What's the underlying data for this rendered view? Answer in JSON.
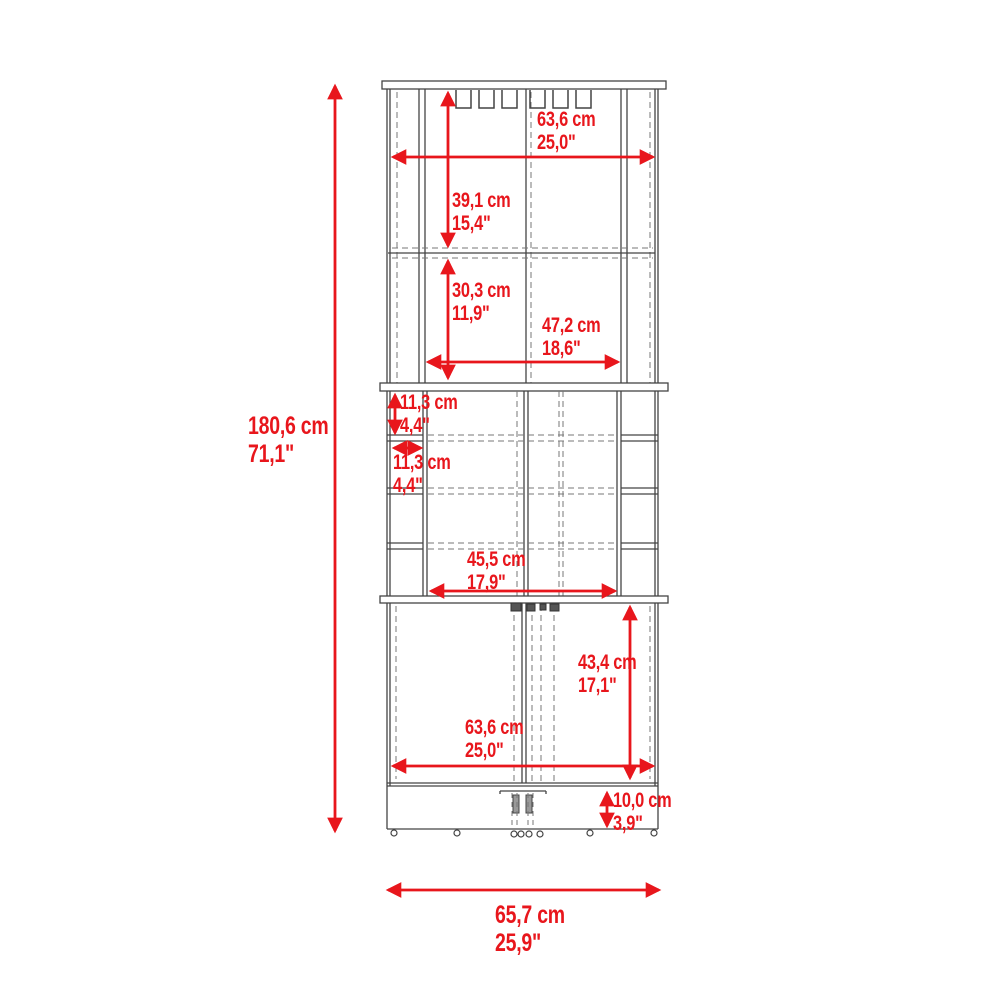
{
  "title": "Corner bar cabinet dimensional diagram",
  "accent_color": "#e8161c",
  "line_color": "#444444",
  "dashed_line_color": "#777777",
  "units": [
    "cm",
    "in"
  ],
  "dimensions": {
    "overall_height": {
      "cm": "180,6 cm",
      "in": "71,1\""
    },
    "top_width": {
      "cm": "63,6 cm",
      "in": "25,0\""
    },
    "hutch_top_height": {
      "cm": "39,1 cm",
      "in": "15,4\""
    },
    "hutch_bottom_height": {
      "cm": "30,3 cm",
      "in": "11,9\""
    },
    "hutch_inner_width": {
      "cm": "47,2 cm",
      "in": "18,6\""
    },
    "cubby_height": {
      "cm": "11,3 cm",
      "in": "4,4\""
    },
    "cubby_width": {
      "cm": "11,3 cm",
      "in": "4,4\""
    },
    "middle_inner_width": {
      "cm": "45,5 cm",
      "in": "17,9\""
    },
    "door_height": {
      "cm": "43,4 cm",
      "in": "17,1\""
    },
    "cabinet_width": {
      "cm": "63,6 cm",
      "in": "25,0\""
    },
    "base_height": {
      "cm": "10,0 cm",
      "in": "3,9\""
    },
    "overall_width": {
      "cm": "65,7 cm",
      "in": "25,9\""
    }
  }
}
